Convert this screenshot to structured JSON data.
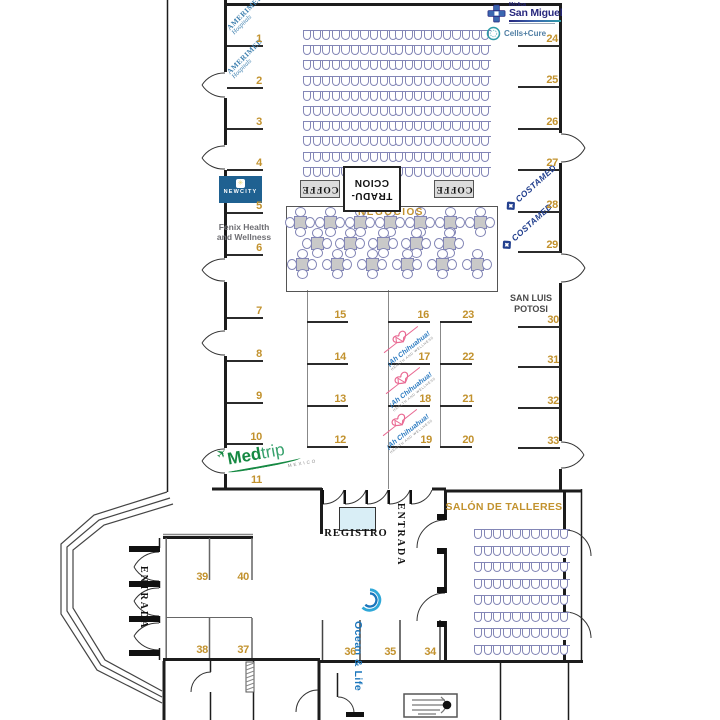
{
  "palette": {
    "gold": "#C2922E",
    "seat_outline": "#8386B6",
    "wall": "#1C1C1C",
    "table_fill": "#C9C9C9",
    "registro_fill": "#D9EEF6",
    "newcity_bg": "#1F6191",
    "amerimed_blue": "#3D7FAE",
    "costamed_navy": "#223F8E",
    "san_miguel_navy": "#27277E",
    "cells_cure_teal": "#2E9BA8",
    "ah_chihuahua_blue": "#2E7CC1",
    "ah_chihuahua_pink": "#E96A93",
    "medtrip_green": "#168943",
    "ocean_blue": "#1B76BC",
    "fenix_gray": "#6E6E73"
  },
  "areas": {
    "negocios": "NEGOCIOS",
    "tradu_line1": "TRADU-",
    "tradu_line2": "CCION",
    "coffe": "COFFE",
    "registro": "REGISTRO",
    "entrada": "ENTRADA",
    "salon_talleres": "SALÓN DE TALLERES",
    "san_luis_line1": "SAN LUIS",
    "san_luis_line2": "POTOSI"
  },
  "exhibitors": {
    "amerimed": {
      "name": "AMERIMED",
      "sub": "Hospitals"
    },
    "newcity": {
      "name": "NEWCITY"
    },
    "fenix": {
      "line1": "Fenix Health",
      "line2": "and Wellness"
    },
    "medtrip": {
      "name_bold": "Med",
      "name_light": "trip",
      "sub": "MEXICO"
    },
    "san_miguel": {
      "pre": "Médica",
      "name": "San Miguel"
    },
    "cells_cure": {
      "name": "Cells+Cure"
    },
    "costamed": {
      "name": "COSTAMED"
    },
    "ah_chihuahua": {
      "name": "¡Ah Chihuahua!",
      "sub": "HEALTH AND WELLNESS"
    },
    "ocean_life": {
      "name": "Ocean & Life"
    }
  },
  "booths": [
    {
      "label": "1",
      "x": 262,
      "y": 45
    },
    {
      "label": "2",
      "x": 262,
      "y": 87
    },
    {
      "label": "3",
      "x": 262,
      "y": 128
    },
    {
      "label": "4",
      "x": 262,
      "y": 169
    },
    {
      "label": "5",
      "x": 262,
      "y": 212
    },
    {
      "label": "6",
      "x": 262,
      "y": 254
    },
    {
      "label": "7",
      "x": 262,
      "y": 317
    },
    {
      "label": "8",
      "x": 262,
      "y": 360
    },
    {
      "label": "9",
      "x": 262,
      "y": 402
    },
    {
      "label": "10",
      "x": 262,
      "y": 443
    },
    {
      "label": "11",
      "x": 262,
      "y": 486
    },
    {
      "label": "12",
      "x": 346,
      "y": 446
    },
    {
      "label": "13",
      "x": 346,
      "y": 405
    },
    {
      "label": "14",
      "x": 346,
      "y": 363
    },
    {
      "label": "15",
      "x": 346,
      "y": 321
    },
    {
      "label": "16",
      "x": 429,
      "y": 321
    },
    {
      "label": "17",
      "x": 430,
      "y": 363
    },
    {
      "label": "18",
      "x": 431,
      "y": 405
    },
    {
      "label": "19",
      "x": 432,
      "y": 446
    },
    {
      "label": "20",
      "x": 474,
      "y": 446
    },
    {
      "label": "21",
      "x": 474,
      "y": 405
    },
    {
      "label": "22",
      "x": 474,
      "y": 363
    },
    {
      "label": "23",
      "x": 474,
      "y": 321
    },
    {
      "label": "24",
      "x": 558,
      "y": 45
    },
    {
      "label": "25",
      "x": 558,
      "y": 86
    },
    {
      "label": "26",
      "x": 558,
      "y": 128
    },
    {
      "label": "27",
      "x": 558,
      "y": 169
    },
    {
      "label": "28",
      "x": 558,
      "y": 211
    },
    {
      "label": "29",
      "x": 558,
      "y": 251
    },
    {
      "label": "30",
      "x": 559,
      "y": 326
    },
    {
      "label": "31",
      "x": 559,
      "y": 366
    },
    {
      "label": "32",
      "x": 559,
      "y": 407
    },
    {
      "label": "33",
      "x": 559,
      "y": 447
    },
    {
      "label": "34",
      "x": 436,
      "y": 658
    },
    {
      "label": "35",
      "x": 396,
      "y": 658
    },
    {
      "label": "36",
      "x": 356,
      "y": 658
    },
    {
      "label": "37",
      "x": 249,
      "y": 656
    },
    {
      "label": "38",
      "x": 208,
      "y": 656
    },
    {
      "label": "39",
      "x": 208,
      "y": 583
    },
    {
      "label": "40",
      "x": 249,
      "y": 583
    }
  ],
  "seating": {
    "top_left": {
      "rows": 10,
      "seats_per_row": 10
    },
    "top_right": {
      "rows": 10,
      "seats_per_row": 10
    },
    "salon": {
      "rows": 8,
      "seats_per_row": 10
    }
  },
  "negocios_tables": {
    "row_counts": [
      7,
      5,
      6
    ],
    "total": 18
  }
}
